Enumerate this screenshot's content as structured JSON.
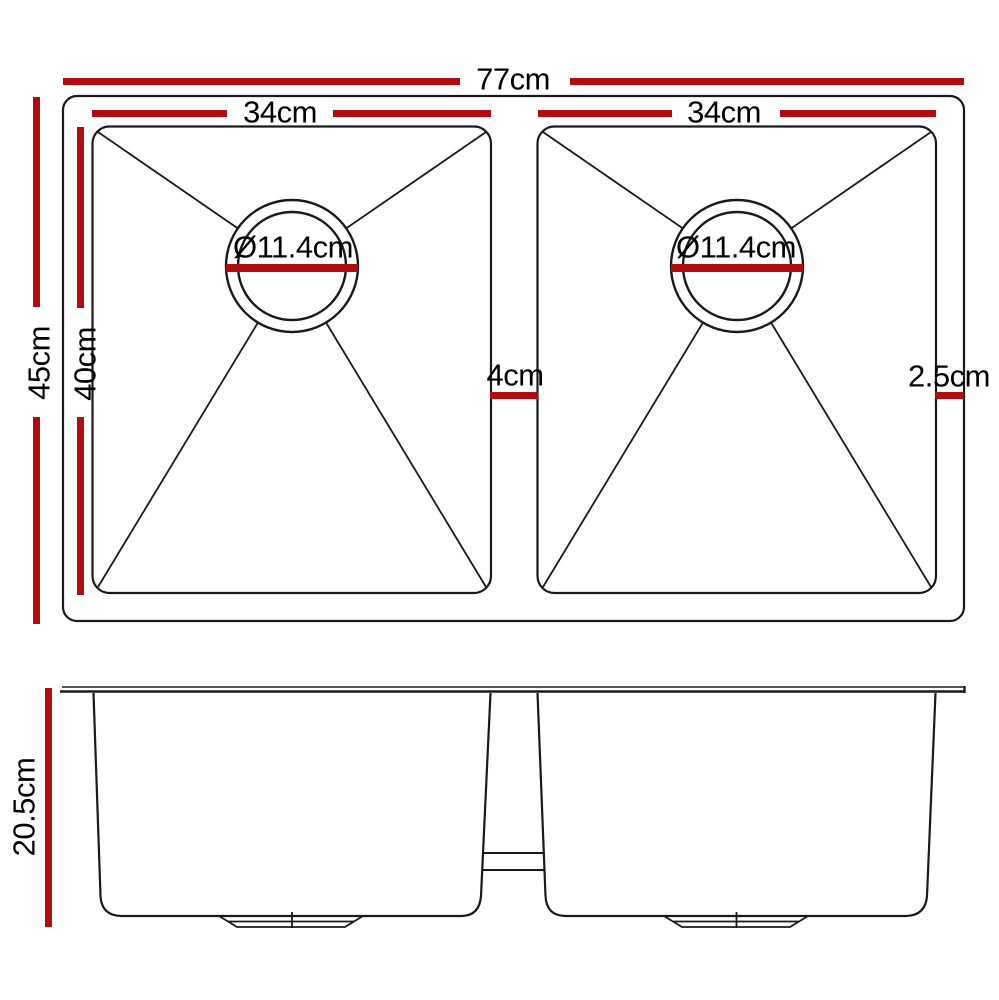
{
  "colors": {
    "accent": "#B00D10",
    "line": "#1A1A1A",
    "background": "#FFFFFF"
  },
  "top_view": {
    "overall_width": "77cm",
    "left_bowl_width": "34cm",
    "right_bowl_width": "34cm",
    "overall_depth": "45cm",
    "bowl_depth": "40cm",
    "left_drain_diameter": "Ø11.4cm",
    "right_drain_diameter": "Ø11.4cm",
    "bowl_gap": "4cm",
    "right_edge_offset": "2.5cm"
  },
  "side_view": {
    "bowl_height": "20.5cm"
  }
}
